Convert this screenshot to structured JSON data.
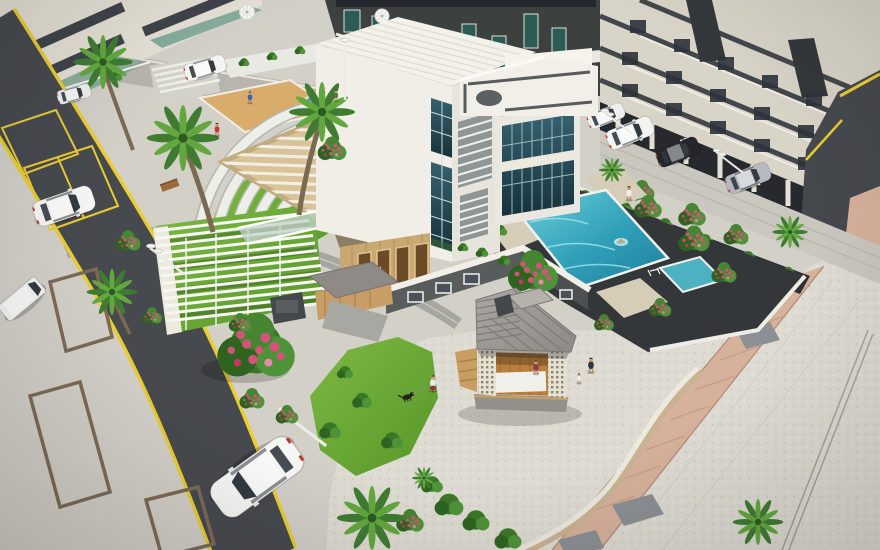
{
  "scene": {
    "title": "Aerial 3D architectural rendering of a residential clubhouse courtyard with swimming pool, gazebo, amphitheater, roads and landscaped grounds",
    "medium": "photorealistic 3D architectural visualization",
    "camera": "high-angle aerial three-quarter view",
    "areas": {
      "clubhouse": {
        "label": "Modern white clubhouse with tall glass curtain wall, louver vents, rooftop terrace with dark circle motif, timber slat pergola roof and wooden door wall"
      },
      "pool": {
        "label": "Turquoise swimming pool on dark sun deck with kids pool, ladders, beige walkway strips and flowering shrubs"
      },
      "gazebo": {
        "label": "Timber gazebo with grey shingle hip roof, cupola, lattice block columns and wooden floor on a circular paved plaza"
      },
      "amphitheater": {
        "label": "Curved white amphitheater steps around a lawn with sand play pit, small water feature and wide entry stairs"
      },
      "promenade": {
        "label": "Large speckled paving promenade crossed by a pink clay-tile walkway, grey stone pavers and a wavy white garden wall"
      },
      "roads": {
        "label": "Dark asphalt internal road with yellow edge lines and painted parking bays, curving from top-left to bottom-center"
      },
      "parking": {
        "label": "Light paved parking area with brown-outlined stalls, parked white sedan and white van"
      },
      "buildings": {
        "label": "Surrounding cream apartment buildings with dark balcony bands, stilt parking with cars and street lamps"
      },
      "landscape": {
        "label": "Palm trees, bright lawns, hedges and pink flowering shrubs throughout the grounds"
      },
      "white_pergola": {
        "label": "White louvered canopy over a grass seating terrace beside the road"
      }
    },
    "people": {
      "count": 9,
      "activities": [
        "walking a dog on the plaza",
        "father walking with child",
        "sitting inside gazebo",
        "standing at pool edge",
        "swimming in pool",
        "walking on amphitheater steps",
        "standing in sand pit",
        "walking on garden path"
      ]
    },
    "vehicles": {
      "cars_visible": 8,
      "list": [
        "white hatchback driving on main road",
        "white sedan in parking bay",
        "white van in stall",
        "white car on rear road",
        "white car under stilt building",
        "dark car under stilt building",
        "silver car under stilt building",
        "white car under entrance canopy"
      ]
    },
    "landscape_counts": {
      "palm_trees": 9,
      "flowering_shrubs": 18,
      "street_lamps": 5
    }
  },
  "palette": {
    "paving_base": "#d3d0c8",
    "promenade": "#dedbd2",
    "asphalt": "#46494e",
    "road_marking": "#e9cd32",
    "stall_outline": "#7d6a55",
    "sand": "#d8ad6b",
    "lawn_light": "#7eb843",
    "lawn_dark": "#569729",
    "pool_light": "#6fd0da",
    "pool_mid": "#2f9fb7",
    "pool_deep": "#1f7f9c",
    "water_kids": "#4cb2c2",
    "pool_deck": "#33373a",
    "boundary_wall": "#2c3033",
    "building_cream": "#d9d4c8",
    "building_dark": "#3c403e",
    "building_light": "#e6e1d6",
    "white_trim": "#f1efe8",
    "wood_cladding": "#c9a871",
    "pergola_wood": "#d8c498",
    "roof_light": "#aba8a3",
    "roof_dark": "#8d8a85",
    "walkway_pink": "#d6b19b",
    "flower_pink": "#d5537a",
    "palm_green_dark": "#3f7c31",
    "palm_green_light": "#63a83e",
    "glass_light": "#35616f",
    "glass_dark": "#16323c"
  }
}
